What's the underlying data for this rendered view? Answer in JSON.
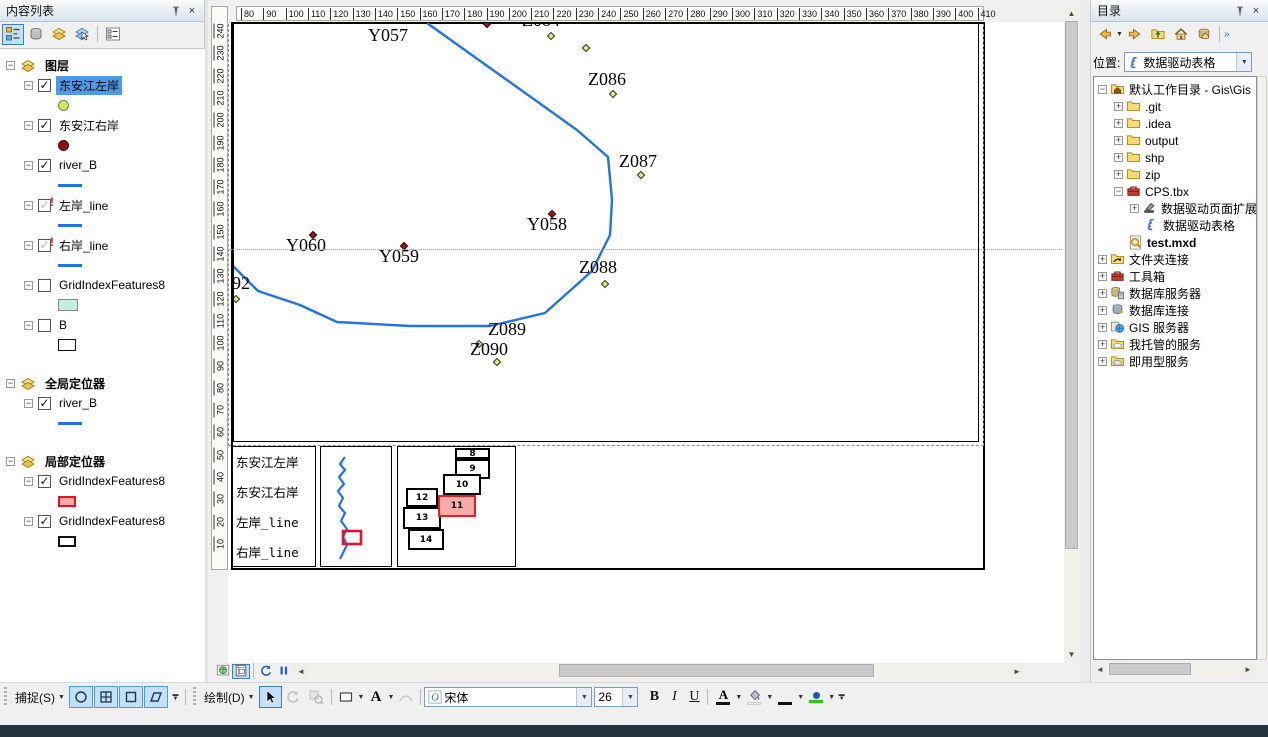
{
  "toc": {
    "title": "内容列表",
    "toolbar": [
      {
        "name": "list-by-drawing-order",
        "selected": true
      },
      {
        "name": "list-by-source",
        "selected": false
      },
      {
        "name": "list-by-visibility",
        "selected": false
      },
      {
        "name": "list-by-selection",
        "selected": false
      },
      {
        "name": "options",
        "selected": false
      }
    ],
    "groups": [
      {
        "label": "图层",
        "items": [
          {
            "label": "东安江左岸",
            "check": "checked",
            "selected": true,
            "symbol": "green-dot"
          },
          {
            "label": "东安江右岸",
            "check": "checked",
            "symbol": "darkred-dot"
          },
          {
            "label": "river_B",
            "check": "checked",
            "symbol": "blue-line"
          },
          {
            "label": "左岸_line",
            "check": "broken",
            "symbol": "blue-line"
          },
          {
            "label": "右岸_line",
            "check": "broken",
            "symbol": "blue-line"
          },
          {
            "label": "GridIndexFeatures8",
            "check": "unchecked",
            "symbol": "cyan-rect"
          },
          {
            "label": "B",
            "check": "unchecked",
            "symbol": "white-rect"
          }
        ]
      },
      {
        "label": "全局定位器",
        "items": [
          {
            "label": "river_B",
            "check": "checked",
            "symbol": "blue-line"
          }
        ]
      },
      {
        "label": "局部定位器",
        "items": [
          {
            "label": "GridIndexFeatures8",
            "check": "checked",
            "symbol": "pink-rect"
          },
          {
            "label": "GridIndexFeatures8",
            "check": "checked",
            "symbol": "black-rect"
          }
        ]
      }
    ]
  },
  "map": {
    "h_ruler": [
      80,
      90,
      100,
      110,
      120,
      130,
      140,
      150,
      160,
      170,
      180,
      190,
      200,
      210,
      220,
      230,
      240,
      250,
      260,
      270,
      280,
      290,
      300,
      310,
      320,
      330,
      340,
      350,
      360,
      370,
      380,
      390,
      400,
      410
    ],
    "v_ruler": [
      240,
      230,
      220,
      210,
      200,
      190,
      180,
      170,
      160,
      150,
      140,
      130,
      120,
      110,
      100,
      90,
      80,
      70,
      60,
      50,
      40,
      30,
      20,
      10
    ],
    "colors": {
      "river": "#2273E6",
      "y_point": "#8F1D1D",
      "z_point": "#D8EC7C",
      "guide": "#3EC8D8",
      "highlight_fill": "#F7ABAB",
      "highlight_border": "#E02020"
    },
    "river": [
      [
        193,
        0
      ],
      [
        343,
        107
      ],
      [
        374,
        134
      ],
      [
        378,
        177
      ],
      [
        376,
        212
      ],
      [
        358,
        248
      ],
      [
        311,
        290
      ],
      [
        256,
        303
      ],
      [
        176,
        303
      ],
      [
        103,
        299
      ],
      [
        66,
        282
      ],
      [
        24,
        268
      ],
      [
        -3,
        241
      ]
    ],
    "labels": [
      {
        "text": "Y057",
        "x": 134,
        "y": 2
      },
      {
        "text": "Z084",
        "x": 288,
        "y": -13
      },
      {
        "text": "Z086",
        "x": 354,
        "y": 46
      },
      {
        "text": "Z087",
        "x": 385,
        "y": 128
      },
      {
        "text": "Y058",
        "x": 293,
        "y": 191
      },
      {
        "text": "Y060",
        "x": 52,
        "y": 212
      },
      {
        "text": "Y059",
        "x": 145,
        "y": 223
      },
      {
        "text": "Z088",
        "x": 345,
        "y": 234
      },
      {
        "text": "092",
        "x": -11,
        "y": 250
      },
      {
        "text": "Z089",
        "x": 254,
        "y": 296
      },
      {
        "text": "Z090",
        "x": 236,
        "y": 316
      }
    ],
    "points": [
      {
        "x": 250,
        "y": -2,
        "t": "y"
      },
      {
        "x": 315,
        "y": 188,
        "t": "y"
      },
      {
        "x": 167,
        "y": 220,
        "t": "y"
      },
      {
        "x": 76,
        "y": 209,
        "t": "y"
      },
      {
        "x": 314,
        "y": 10,
        "t": "z"
      },
      {
        "x": 349,
        "y": 22,
        "t": "z"
      },
      {
        "x": 376,
        "y": 68,
        "t": "z"
      },
      {
        "x": 404,
        "y": 149,
        "t": "z"
      },
      {
        "x": 368,
        "y": 258,
        "t": "z"
      },
      {
        "x": 242,
        "y": 318,
        "t": "z"
      },
      {
        "x": 260,
        "y": 336,
        "t": "z"
      },
      {
        "x": -1,
        "y": 273,
        "t": "z"
      }
    ],
    "legend": {
      "lines": [
        "东安江左岸",
        "东安江右岸",
        "左岸_line",
        "右岸_line"
      ]
    },
    "minimap": {
      "river": [
        [
          24,
          10
        ],
        [
          19,
          17
        ],
        [
          24,
          23
        ],
        [
          18,
          30
        ],
        [
          23,
          37
        ],
        [
          17,
          44
        ],
        [
          22,
          51
        ],
        [
          18,
          59
        ],
        [
          24,
          66
        ],
        [
          20,
          74
        ],
        [
          26,
          82
        ],
        [
          22,
          90
        ],
        [
          26,
          98
        ],
        [
          22,
          106
        ],
        [
          19,
          112
        ]
      ],
      "highlight": {
        "x": 22,
        "y": 84,
        "w": 18,
        "h": 13
      }
    },
    "grid": {
      "boxes": [
        {
          "n": "8",
          "x": 57,
          "y": 1,
          "w": 35,
          "h": 11,
          "hl": false
        },
        {
          "n": "9",
          "x": 57,
          "y": 12,
          "w": 35,
          "h": 20,
          "hl": false
        },
        {
          "n": "10",
          "x": 45,
          "y": 27,
          "w": 38,
          "h": 21,
          "hl": false
        },
        {
          "n": "12",
          "x": 8,
          "y": 41,
          "w": 32,
          "h": 19,
          "hl": false
        },
        {
          "n": "13",
          "x": 5,
          "y": 60,
          "w": 38,
          "h": 22,
          "hl": false
        },
        {
          "n": "14",
          "x": 10,
          "y": 82,
          "w": 36,
          "h": 21,
          "hl": false
        },
        {
          "n": "11",
          "x": 40,
          "y": 48,
          "w": 38,
          "h": 22,
          "hl": true
        }
      ]
    }
  },
  "catalog": {
    "title": "目录",
    "location_label": "位置:",
    "location_value": "数据驱动表格",
    "items": [
      {
        "label": "默认工作目录 - Gis\\Gis",
        "level": 0,
        "icon": "folder-home",
        "exp": "-"
      },
      {
        "label": ".git",
        "level": 1,
        "icon": "folder",
        "exp": "+"
      },
      {
        "label": ".idea",
        "level": 1,
        "icon": "folder",
        "exp": "+"
      },
      {
        "label": "output",
        "level": 1,
        "icon": "folder",
        "exp": "+"
      },
      {
        "label": "shp",
        "level": 1,
        "icon": "folder",
        "exp": "+"
      },
      {
        "label": "zip",
        "level": 1,
        "icon": "folder",
        "exp": "+"
      },
      {
        "label": "CPS.tbx",
        "level": 1,
        "icon": "toolbox",
        "exp": "-"
      },
      {
        "label": "数据驱动页面扩展",
        "level": 2,
        "icon": "hammer",
        "exp": "+"
      },
      {
        "label": "数据驱动表格",
        "level": 2,
        "icon": "scroll",
        "exp": ""
      },
      {
        "label": "test.mxd",
        "level": 1,
        "icon": "mxd",
        "exp": "",
        "bold": true
      },
      {
        "label": "文件夹连接",
        "level": 0,
        "icon": "folder-link",
        "exp": "+"
      },
      {
        "label": "工具箱",
        "level": 0,
        "icon": "toolbox",
        "exp": "+"
      },
      {
        "label": "数据库服务器",
        "level": 0,
        "icon": "db-server",
        "exp": "+"
      },
      {
        "label": "数据库连接",
        "level": 0,
        "icon": "db-connect",
        "exp": "+"
      },
      {
        "label": "GIS 服务器",
        "level": 0,
        "icon": "gis",
        "exp": "+"
      },
      {
        "label": "我托管的服务",
        "level": 0,
        "icon": "cloud",
        "exp": "+"
      },
      {
        "label": "即用型服务",
        "level": 0,
        "icon": "cloud2",
        "exp": "+"
      }
    ]
  },
  "toolbar": {
    "snap": "捕捉(S)",
    "draw": "绘制(D)",
    "font": "宋体",
    "size": "26",
    "bold": "B",
    "italic": "I",
    "underline": "U",
    "text_a": "A"
  }
}
